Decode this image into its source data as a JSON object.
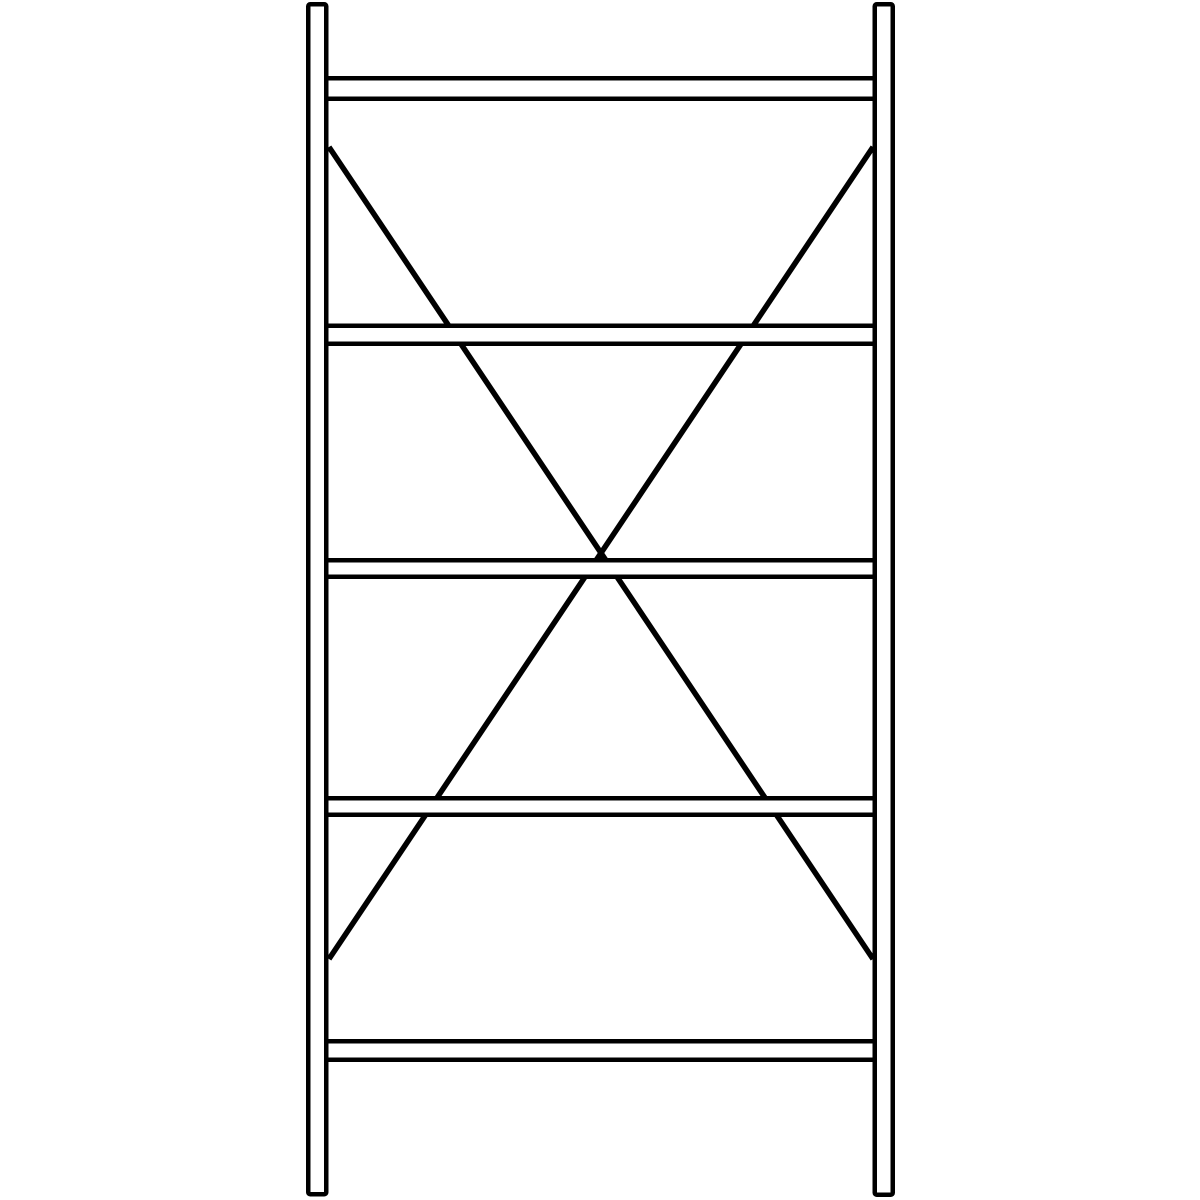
{
  "page": {
    "width": 1200,
    "height": 1200,
    "background": "#ffffff"
  },
  "drawing": {
    "description": "Technical line drawing of an empty steel shelf unit: two vertical uprights, five horizontal shelf levels, rear diagonal X cross-bracing",
    "stroke_color": "#000000",
    "fill_color": "#ffffff",
    "uprights": [
      {
        "id": "left-upright",
        "x": 308.25,
        "y": 4.25,
        "width": 18,
        "height": 1190,
        "stroke_width": 4.5,
        "corner_radius": 2
      },
      {
        "id": "right-upright",
        "x": 874.75,
        "y": 4.25,
        "width": 18,
        "height": 1190.5,
        "stroke_width": 4.5,
        "corner_radius": 2
      }
    ],
    "shelves": [
      {
        "id": "shelf-1",
        "x": 324,
        "y": 78.25,
        "width": 554,
        "height": 20.5,
        "stroke_width": 4.5
      },
      {
        "id": "shelf-2",
        "x": 324,
        "y": 325.75,
        "width": 554,
        "height": 18,
        "stroke_width": 4.5
      },
      {
        "id": "shelf-3",
        "x": 324,
        "y": 560.25,
        "width": 554,
        "height": 16.5,
        "stroke_width": 4.5
      },
      {
        "id": "shelf-4",
        "x": 324,
        "y": 798.25,
        "width": 554,
        "height": 16.5,
        "stroke_width": 4.5
      },
      {
        "id": "shelf-5",
        "x": 324,
        "y": 1041.25,
        "width": 554,
        "height": 18.5,
        "stroke_width": 4.5
      }
    ],
    "braces": [
      {
        "id": "cross-brace-down-right",
        "x1": 329,
        "y1": 147,
        "x2": 873,
        "y2": 959,
        "stroke_width": 5.5
      },
      {
        "id": "cross-brace-down-left",
        "x1": 873,
        "y1": 147,
        "x2": 329,
        "y2": 959,
        "stroke_width": 5.5
      }
    ]
  }
}
